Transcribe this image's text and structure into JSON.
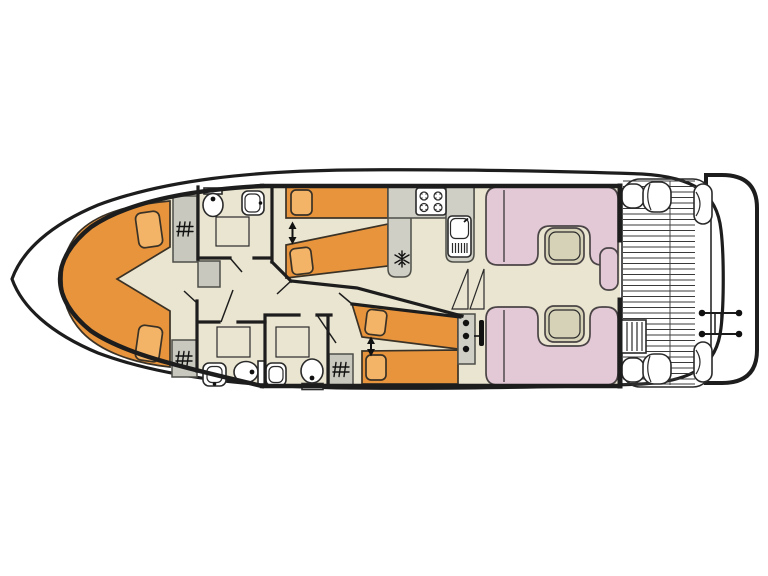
{
  "plan": {
    "type": "houseboat-deck-plan",
    "orientation": "bow-left-stern-right"
  },
  "colors": {
    "background": "#ffffff",
    "outline": "#1d1d1d",
    "floor": "#eae5d0",
    "bed": "#e8943c",
    "pillow": "#f3b468",
    "seat": "#e3c9d6",
    "table": "#d6d2b8",
    "counter": "#d0cfc6",
    "wardrobe": "#c9c8bf",
    "steps": "#dcdbd2",
    "hardware": "#111111"
  },
  "legend": {
    "orange_shape": "bed / berth",
    "pink_shape": "saloon seating",
    "grid_square": "shower",
    "hatch_square": "wardrobe",
    "snowflake": "refrigerator",
    "double_arrow": "beds convert to double",
    "triangles": "companionway steps",
    "slatted_area": "aft deck",
    "dot_console": "helm controls",
    "rail_with_pins": "stern swim ladder"
  },
  "inventory": {
    "cabins": 3,
    "v_double_berth_bow": 1,
    "convertible_single_berths": 4,
    "bathrooms": 3,
    "showers": 3,
    "toilets": 3,
    "washbasins": 3,
    "wardrobes": 3,
    "stove_burners": 4,
    "galley_sink": 1,
    "refrigerator": 1,
    "dinette_tables": 2,
    "deck_corner_seats": 4,
    "deck_table": 1,
    "stern_ladder": 1,
    "helm_controls": 3
  }
}
